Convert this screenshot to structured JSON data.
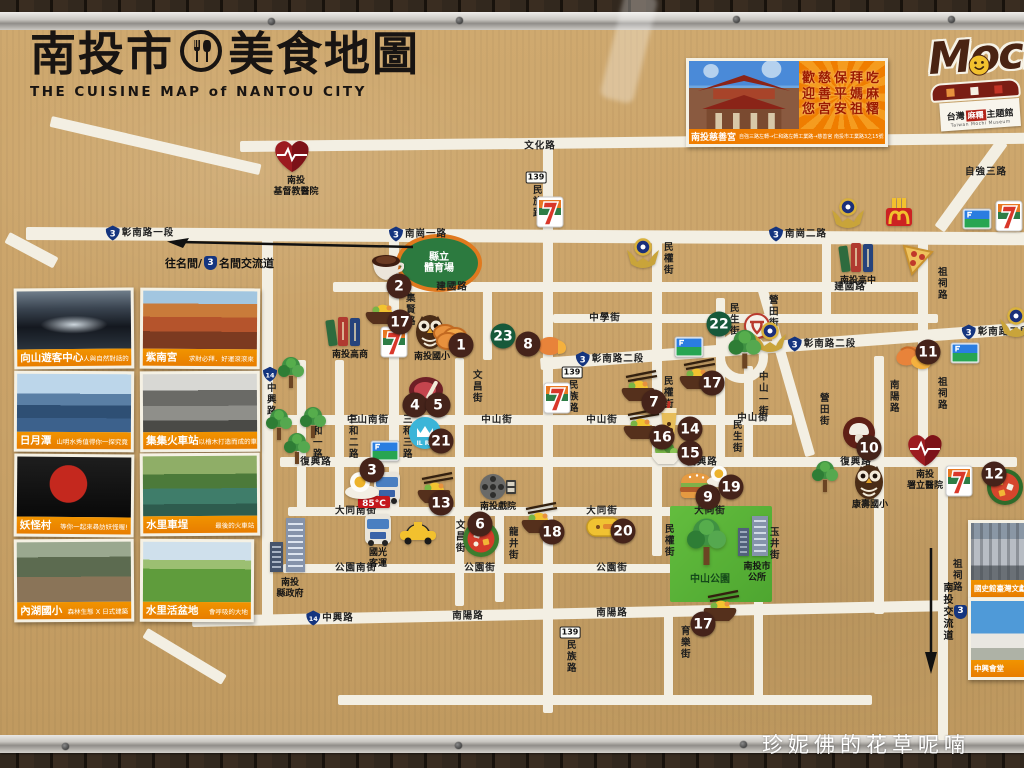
{
  "board": {
    "title_zh_left": "南投市",
    "title_zh_right": "美食地圖",
    "title_en": "THE CUISINE MAP of NANTOU CITY",
    "watermark": "珍妮佛的花草呢喃"
  },
  "promo": {
    "slogan_rows": [
      "歡慈保拜吃",
      "迎善平媽麻",
      "您宮安祖糬"
    ],
    "name": "南投慈善宮",
    "directions": "自強三路左轉→仁和路左轉工業路→慈善宮 南投市工業路3之15號"
  },
  "mochi": {
    "wordmark": "Mochi",
    "tag_zh1": "台灣",
    "tag_red": "麻糬",
    "tag_zh2": "主題館",
    "tag_en": "Taiwan Mochi Museum"
  },
  "arrows": {
    "west": {
      "prefix": "往名間/",
      "shield": "3",
      "suffix": "名間交流道"
    },
    "southeast": {
      "prefix": "往中興新村/",
      "shield": "3",
      "suffix": "南投交流道"
    }
  },
  "sidebar_cards": [
    {
      "name": "向山遊客中心",
      "caption": "人與自然對話的「秘境」",
      "photo": "xiangshan",
      "x": 14,
      "y": 288,
      "w": 114,
      "h": 75,
      "rot": -0.5
    },
    {
      "name": "紫南宮",
      "caption": "求財必拜．好運滾滾來",
      "photo": "zinan",
      "x": 140,
      "y": 288,
      "w": 114,
      "h": 75,
      "rot": 0.4
    },
    {
      "name": "日月潭",
      "caption": "山明水秀值得你一探究竟",
      "photo": "sunmoon",
      "x": 14,
      "y": 371,
      "w": 114,
      "h": 75,
      "rot": 0.3
    },
    {
      "name": "集集火車站",
      "caption": "以檜木打造而成的車站",
      "photo": "jiji",
      "x": 140,
      "y": 371,
      "w": 114,
      "h": 75,
      "rot": -0.3
    },
    {
      "name": "妖怪村",
      "caption": "等你一起來尋訪妖怪喔!",
      "photo": "yaoguai",
      "x": 14,
      "y": 454,
      "w": 114,
      "h": 77,
      "rot": 0.5
    },
    {
      "name": "水里車埕",
      "caption": "最後的火車站",
      "photo": "checheng",
      "x": 140,
      "y": 453,
      "w": 114,
      "h": 77,
      "rot": -0.4
    },
    {
      "name": "內湖國小",
      "caption": "森林生態 X 日式建築",
      "photo": "neihu",
      "x": 14,
      "y": 539,
      "w": 114,
      "h": 77,
      "rot": -0.4
    },
    {
      "name": "水里活盆地",
      "caption": "會呼吸的大地",
      "photo": "basin",
      "x": 140,
      "y": 539,
      "w": 108,
      "h": 77,
      "rot": 0.3
    }
  ],
  "corner_cards": [
    {
      "name": "國史館臺灣文獻館",
      "photo": "archives",
      "x": 968,
      "y": 520,
      "w": 56,
      "h": 74
    },
    {
      "name": "中興會堂",
      "photo": "hall",
      "x": 968,
      "y": 598,
      "w": 56,
      "h": 76
    }
  ],
  "map": {
    "stadium": {
      "x": 396,
      "y": 234,
      "w": 78,
      "h": 50,
      "label": "縣立\n體育場"
    },
    "park": {
      "x": 670,
      "y": 506,
      "w": 102,
      "h": 96,
      "label": "中山公園"
    },
    "roundabout": {
      "cx": 742,
      "cy": 357,
      "r": 26
    },
    "roads": [
      {
        "x": 240,
        "y": 141,
        "w": 790,
        "h": 11,
        "r": -0.6
      },
      {
        "x": 52,
        "y": 116,
        "w": 215,
        "h": 11,
        "r": 13
      },
      {
        "x": 26,
        "y": 227,
        "w": 1000,
        "h": 13,
        "r": 0.3
      },
      {
        "x": 10,
        "y": 232,
        "w": 55,
        "h": 12,
        "r": 28
      },
      {
        "x": 333,
        "y": 282,
        "w": 588,
        "h": 10
      },
      {
        "x": 553,
        "y": 314,
        "w": 385,
        "h": 9
      },
      {
        "x": 540,
        "y": 358,
        "w": 500,
        "h": 12,
        "r": -4.2
      },
      {
        "x": 280,
        "y": 415,
        "w": 512,
        "h": 10
      },
      {
        "x": 280,
        "y": 457,
        "w": 737,
        "h": 10
      },
      {
        "x": 288,
        "y": 507,
        "w": 484,
        "h": 9
      },
      {
        "x": 283,
        "y": 564,
        "w": 388,
        "h": 9
      },
      {
        "x": 192,
        "y": 616,
        "w": 752,
        "h": 11,
        "r": -1.2
      },
      {
        "x": 338,
        "y": 695,
        "w": 534,
        "h": 10
      },
      {
        "x": 148,
        "y": 628,
        "w": 92,
        "h": 11,
        "r": 31
      },
      {
        "x": 262,
        "y": 234,
        "w": 11,
        "h": 390
      },
      {
        "x": 297,
        "y": 360,
        "w": 9,
        "h": 153
      },
      {
        "x": 335,
        "y": 360,
        "w": 9,
        "h": 153
      },
      {
        "x": 389,
        "y": 234,
        "w": 10,
        "h": 280
      },
      {
        "x": 455,
        "y": 358,
        "w": 9,
        "h": 248
      },
      {
        "x": 483,
        "y": 286,
        "w": 9,
        "h": 74
      },
      {
        "x": 543,
        "y": 139,
        "w": 10,
        "h": 574
      },
      {
        "x": 495,
        "y": 510,
        "w": 9,
        "h": 92
      },
      {
        "x": 652,
        "y": 234,
        "w": 10,
        "h": 322
      },
      {
        "x": 716,
        "y": 298,
        "w": 9,
        "h": 164
      },
      {
        "x": 744,
        "y": 366,
        "w": 9,
        "h": 94
      },
      {
        "x": 757,
        "y": 288,
        "w": 10,
        "h": 176,
        "r": -16
      },
      {
        "x": 874,
        "y": 356,
        "w": 10,
        "h": 258
      },
      {
        "x": 918,
        "y": 242,
        "w": 10,
        "h": 222
      },
      {
        "x": 938,
        "y": 458,
        "w": 10,
        "h": 282
      },
      {
        "x": 664,
        "y": 610,
        "w": 9,
        "h": 88
      },
      {
        "x": 754,
        "y": 510,
        "w": 9,
        "h": 188
      },
      {
        "x": 998,
        "y": 138,
        "w": 12,
        "h": 108,
        "r": 36
      },
      {
        "x": 822,
        "y": 239,
        "w": 9,
        "h": 78
      }
    ],
    "labels": [
      {
        "t": "彰南路一段",
        "x": 140,
        "y": 233,
        "s": "3"
      },
      {
        "t": "南崗一路",
        "x": 418,
        "y": 234,
        "s": "3"
      },
      {
        "t": "南崗二路",
        "x": 798,
        "y": 234,
        "s": "3"
      },
      {
        "t": "文化路",
        "x": 540,
        "y": 146
      },
      {
        "t": "文化路",
        "x": 800,
        "y": 140
      },
      {
        "t": "自強三路",
        "x": 986,
        "y": 172
      },
      {
        "t": "建國路",
        "x": 452,
        "y": 287
      },
      {
        "t": "建國路",
        "x": 850,
        "y": 287
      },
      {
        "t": "中學街",
        "x": 605,
        "y": 318
      },
      {
        "t": "彰南路二段",
        "x": 610,
        "y": 359,
        "s": "3"
      },
      {
        "t": "彰南路二段",
        "x": 822,
        "y": 344,
        "s": "3"
      },
      {
        "t": "彰南路二段",
        "x": 996,
        "y": 332,
        "s": "3"
      },
      {
        "t": "中山南街",
        "x": 368,
        "y": 420
      },
      {
        "t": "中山街",
        "x": 497,
        "y": 420
      },
      {
        "t": "中山街",
        "x": 602,
        "y": 420
      },
      {
        "t": "中山街",
        "x": 753,
        "y": 418
      },
      {
        "t": "復興路",
        "x": 316,
        "y": 462
      },
      {
        "t": "復興路",
        "x": 702,
        "y": 462
      },
      {
        "t": "復興路",
        "x": 856,
        "y": 462
      },
      {
        "t": "大同南街",
        "x": 356,
        "y": 511
      },
      {
        "t": "大同街",
        "x": 602,
        "y": 511
      },
      {
        "t": "大同街",
        "x": 710,
        "y": 511
      },
      {
        "t": "公園南街",
        "x": 356,
        "y": 568
      },
      {
        "t": "公園街",
        "x": 480,
        "y": 568
      },
      {
        "t": "公園街",
        "x": 612,
        "y": 568
      },
      {
        "t": "中興路",
        "x": 330,
        "y": 618,
        "s": "14"
      },
      {
        "t": "南陽路",
        "x": 468,
        "y": 616
      },
      {
        "t": "南陽路",
        "x": 612,
        "y": 613
      },
      {
        "t": "中興路",
        "x": 270,
        "y": 392,
        "v": 1,
        "s": "14"
      },
      {
        "t": "三和一路",
        "x": 316,
        "y": 437,
        "v": 1
      },
      {
        "t": "三和二路",
        "x": 352,
        "y": 437,
        "v": 1
      },
      {
        "t": "三和三路",
        "x": 406,
        "y": 437,
        "v": 1
      },
      {
        "t": "集賢路",
        "x": 409,
        "y": 310,
        "v": 1
      },
      {
        "t": "民族路",
        "x": 536,
        "y": 195,
        "v": 1,
        "s": "139"
      },
      {
        "t": "民族路",
        "x": 572,
        "y": 390,
        "v": 1,
        "s": "139"
      },
      {
        "t": "民族路",
        "x": 570,
        "y": 650,
        "v": 1,
        "s": "139"
      },
      {
        "t": "文昌街",
        "x": 476,
        "y": 387,
        "v": 1
      },
      {
        "t": "文昌街",
        "x": 459,
        "y": 537,
        "v": 1
      },
      {
        "t": "龍井街",
        "x": 512,
        "y": 544,
        "v": 1
      },
      {
        "t": "民生街",
        "x": 733,
        "y": 320,
        "v": 1
      },
      {
        "t": "民生街",
        "x": 736,
        "y": 437,
        "v": 1
      },
      {
        "t": "民權街",
        "x": 667,
        "y": 259,
        "v": 1
      },
      {
        "t": "民權街",
        "x": 667,
        "y": 393,
        "v": 1
      },
      {
        "t": "民權街",
        "x": 668,
        "y": 541,
        "v": 1
      },
      {
        "t": "中山一街",
        "x": 762,
        "y": 394,
        "v": 1
      },
      {
        "t": "營田街",
        "x": 772,
        "y": 312,
        "v": 1
      },
      {
        "t": "營田街",
        "x": 823,
        "y": 410,
        "v": 1
      },
      {
        "t": "南陽路",
        "x": 893,
        "y": 397,
        "v": 1
      },
      {
        "t": "祖祠路",
        "x": 941,
        "y": 284,
        "v": 1
      },
      {
        "t": "祖祠路",
        "x": 941,
        "y": 394,
        "v": 1
      },
      {
        "t": "祖祠路",
        "x": 956,
        "y": 576,
        "v": 1
      },
      {
        "t": "育樂街",
        "x": 684,
        "y": 643,
        "v": 1
      },
      {
        "t": "玉井街",
        "x": 773,
        "y": 544,
        "v": 1
      }
    ],
    "icons": [
      {
        "t": "heart",
        "x": 272,
        "y": 138,
        "label": "南投\n基督教醫院",
        "lx": 296,
        "ly": 176
      },
      {
        "t": "books",
        "x": 325,
        "y": 314,
        "label": "南投高商",
        "lx": 350,
        "ly": 350
      },
      {
        "t": "owl",
        "x": 413,
        "y": 312,
        "label": "南投國小",
        "lx": 432,
        "ly": 352
      },
      {
        "t": "books",
        "x": 838,
        "y": 240,
        "label": "南投高中",
        "lx": 858,
        "ly": 276
      },
      {
        "t": "film",
        "x": 478,
        "y": 472,
        "label": "南投戲院",
        "lx": 498,
        "ly": 502
      },
      {
        "t": "bus",
        "x": 372,
        "y": 470
      },
      {
        "t": "bus",
        "x": 363,
        "y": 512,
        "label": "國光\n客運",
        "lx": 378,
        "ly": 548
      },
      {
        "t": "sign85",
        "x": 358,
        "y": 494
      },
      {
        "t": "taxi",
        "x": 398,
        "y": 520
      },
      {
        "t": "govt",
        "x": 268,
        "y": 516,
        "label": "南投\n縣政府",
        "lx": 290,
        "ly": 578
      },
      {
        "t": "cityhall",
        "x": 736,
        "y": 514,
        "label": "南投市\n公所",
        "lx": 757,
        "ly": 562
      },
      {
        "t": "owl",
        "x": 852,
        "y": 462,
        "label": "康壽國小",
        "lx": 870,
        "ly": 500
      },
      {
        "t": "heart",
        "x": 905,
        "y": 432,
        "label": "南投\n署立醫院",
        "lx": 925,
        "ly": 470
      },
      {
        "t": "post",
        "x": 744,
        "y": 313
      },
      {
        "t": "police",
        "x": 625,
        "y": 236
      },
      {
        "t": "police",
        "x": 752,
        "y": 320
      },
      {
        "t": "police",
        "x": 830,
        "y": 196
      },
      {
        "t": "police",
        "x": 998,
        "y": 305
      },
      {
        "t": "mcd",
        "x": 884,
        "y": 196
      },
      {
        "t": "pizzaslice",
        "x": 900,
        "y": 242
      },
      {
        "t": "seven",
        "x": 536,
        "y": 196
      },
      {
        "t": "seven",
        "x": 380,
        "y": 326
      },
      {
        "t": "seven",
        "x": 543,
        "y": 382
      },
      {
        "t": "seven",
        "x": 995,
        "y": 200
      },
      {
        "t": "seven",
        "x": 945,
        "y": 465
      },
      {
        "t": "famima",
        "x": 370,
        "y": 440
      },
      {
        "t": "famima",
        "x": 674,
        "y": 336
      },
      {
        "t": "famima",
        "x": 962,
        "y": 208
      },
      {
        "t": "famima",
        "x": 950,
        "y": 342
      },
      {
        "t": "tree",
        "x": 276,
        "y": 354
      },
      {
        "t": "tree",
        "x": 264,
        "y": 406
      },
      {
        "t": "tree",
        "x": 298,
        "y": 404
      },
      {
        "t": "tree",
        "x": 282,
        "y": 430
      },
      {
        "t": "tree",
        "x": 810,
        "y": 458
      },
      {
        "t": "tree",
        "x": 726,
        "y": 326,
        "sc": 1.25
      },
      {
        "t": "tree",
        "x": 684,
        "y": 514,
        "sc": 1.5
      },
      {
        "t": "ilre",
        "x": 408,
        "y": 416
      },
      {
        "t": "coins",
        "x": 432,
        "y": 322
      },
      {
        "t": "coffee",
        "x": 368,
        "y": 252
      },
      {
        "t": "bowl",
        "x": 362,
        "y": 298
      },
      {
        "t": "egg",
        "x": 344,
        "y": 470
      },
      {
        "t": "steak",
        "x": 408,
        "y": 376
      },
      {
        "t": "hotpot",
        "x": 462,
        "y": 520
      },
      {
        "t": "bowlC",
        "x": 618,
        "y": 368
      },
      {
        "t": "dumpling",
        "x": 536,
        "y": 332
      },
      {
        "t": "burger",
        "x": 678,
        "y": 470
      },
      {
        "t": "mushroom",
        "x": 842,
        "y": 416
      },
      {
        "t": "croissant",
        "x": 895,
        "y": 344
      },
      {
        "t": "pizzaround",
        "x": 986,
        "y": 468
      },
      {
        "t": "bowlC",
        "x": 414,
        "y": 470
      },
      {
        "t": "drink",
        "x": 658,
        "y": 400
      },
      {
        "t": "salad",
        "x": 650,
        "y": 440
      },
      {
        "t": "bowlC",
        "x": 620,
        "y": 406
      },
      {
        "t": "bowlC",
        "x": 676,
        "y": 356
      },
      {
        "t": "bowlC",
        "x": 700,
        "y": 588
      },
      {
        "t": "bowlC",
        "x": 518,
        "y": 500
      },
      {
        "t": "egg",
        "x": 706,
        "y": 464,
        "sc": 0.8
      },
      {
        "t": "box",
        "x": 586,
        "y": 514
      }
    ],
    "markers": [
      {
        "n": "1",
        "x": 461,
        "y": 345
      },
      {
        "n": "2",
        "x": 399,
        "y": 286
      },
      {
        "n": "3",
        "x": 372,
        "y": 470
      },
      {
        "n": "4",
        "x": 415,
        "y": 405
      },
      {
        "n": "5",
        "x": 438,
        "y": 405
      },
      {
        "n": "6",
        "x": 480,
        "y": 524
      },
      {
        "n": "7",
        "x": 654,
        "y": 402
      },
      {
        "n": "8",
        "x": 528,
        "y": 344
      },
      {
        "n": "9",
        "x": 708,
        "y": 497
      },
      {
        "n": "10",
        "x": 869,
        "y": 448
      },
      {
        "n": "11",
        "x": 928,
        "y": 352
      },
      {
        "n": "12",
        "x": 994,
        "y": 474
      },
      {
        "n": "13",
        "x": 441,
        "y": 503
      },
      {
        "n": "14",
        "x": 690,
        "y": 429
      },
      {
        "n": "15",
        "x": 690,
        "y": 453
      },
      {
        "n": "16",
        "x": 662,
        "y": 437
      },
      {
        "n": "17",
        "x": 400,
        "y": 322
      },
      {
        "n": "17",
        "x": 712,
        "y": 383
      },
      {
        "n": "17",
        "x": 703,
        "y": 624
      },
      {
        "n": "18",
        "x": 552,
        "y": 532
      },
      {
        "n": "19",
        "x": 731,
        "y": 487
      },
      {
        "n": "20",
        "x": 623,
        "y": 531
      },
      {
        "n": "21",
        "x": 441,
        "y": 441
      },
      {
        "n": "22",
        "x": 719,
        "y": 324,
        "g": 1
      },
      {
        "n": "23",
        "x": 503,
        "y": 336,
        "g": 1
      }
    ]
  }
}
